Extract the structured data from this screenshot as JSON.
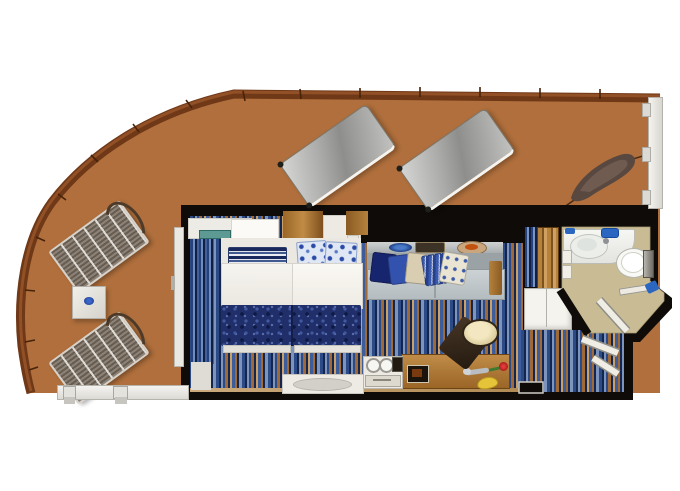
{
  "meta": {
    "description": "Cruise ship stateroom floor plan with large wrap-around balcony",
    "visible_text": "none"
  },
  "palette": {
    "bg": "#ffffff",
    "wall": "#0e0b08",
    "balcony-floor": "#b06f3c",
    "wood-dark": "#6f3817",
    "wood-light": "#99552a",
    "bath-floor": "#c9bc94",
    "accent-blue": "#2b66c0",
    "blanket-navy": "#202e6a",
    "desk-wood": "#9a6526",
    "sofa-gray": "#9aa2a6",
    "railing-white": "#f4f3ef",
    "carpet-blue": "#2c4a86",
    "carpet-navy": "#14264e",
    "carpet-light": "#7d95bd",
    "carpet-brown": "#a06a38",
    "carpet-tan": "#caa06a",
    "carpet-mid": "#3d5c9a"
  },
  "balcony": {
    "name": "wrap-around balcony",
    "items": [
      {
        "name": "padded sun lounger 1"
      },
      {
        "name": "padded sun lounger 2"
      },
      {
        "name": "woven lounge chair 1"
      },
      {
        "name": "woven lounge chair 2"
      },
      {
        "name": "side table with blue dish"
      },
      {
        "name": "privacy windbreak"
      },
      {
        "name": "glass railing right"
      },
      {
        "name": "glass railing bottom"
      },
      {
        "name": "teak deck edge"
      }
    ]
  },
  "cabin": {
    "name": "stateroom",
    "bed_area": {
      "items": [
        {
          "name": "twin bed left"
        },
        {
          "name": "twin bed right"
        },
        {
          "name": "striped pillow"
        },
        {
          "name": "floral pillow left"
        },
        {
          "name": "floral pillow right"
        },
        {
          "name": "patterned bed runner"
        },
        {
          "name": "headboard panels"
        },
        {
          "name": "bench at foot wall"
        }
      ]
    },
    "lounge_area": {
      "items": [
        {
          "name": "sofa"
        },
        {
          "name": "throw pillows",
          "count": 5
        },
        {
          "name": "display shelf"
        },
        {
          "name": "blue dish"
        },
        {
          "name": "tray"
        },
        {
          "name": "fruit plate"
        },
        {
          "name": "wood armrest"
        }
      ]
    },
    "desk_area": {
      "items": [
        {
          "name": "writing desk"
        },
        {
          "name": "stool with round cushion"
        },
        {
          "name": "minibar cabinet"
        },
        {
          "name": "glasses",
          "count": 2
        },
        {
          "name": "tv"
        },
        {
          "name": "picture frame"
        },
        {
          "name": "spoon"
        },
        {
          "name": "rose"
        },
        {
          "name": "banana"
        }
      ]
    },
    "balcony_door": {
      "items": [
        {
          "name": "sliding glass door"
        },
        {
          "name": "striped curtain"
        }
      ]
    },
    "storage": {
      "items": [
        {
          "name": "closet"
        },
        {
          "name": "wardrobe"
        }
      ]
    }
  },
  "bathroom": {
    "name": "bathroom",
    "items": [
      {
        "name": "washbasin counter"
      },
      {
        "name": "basin"
      },
      {
        "name": "toilet"
      },
      {
        "name": "towel rail"
      },
      {
        "name": "blue towel"
      },
      {
        "name": "toiletries"
      },
      {
        "name": "bathroom door"
      }
    ]
  },
  "entry": {
    "name": "entry corridor",
    "items": [
      {
        "name": "entrance door swing"
      },
      {
        "name": "entry carpet"
      }
    ]
  }
}
